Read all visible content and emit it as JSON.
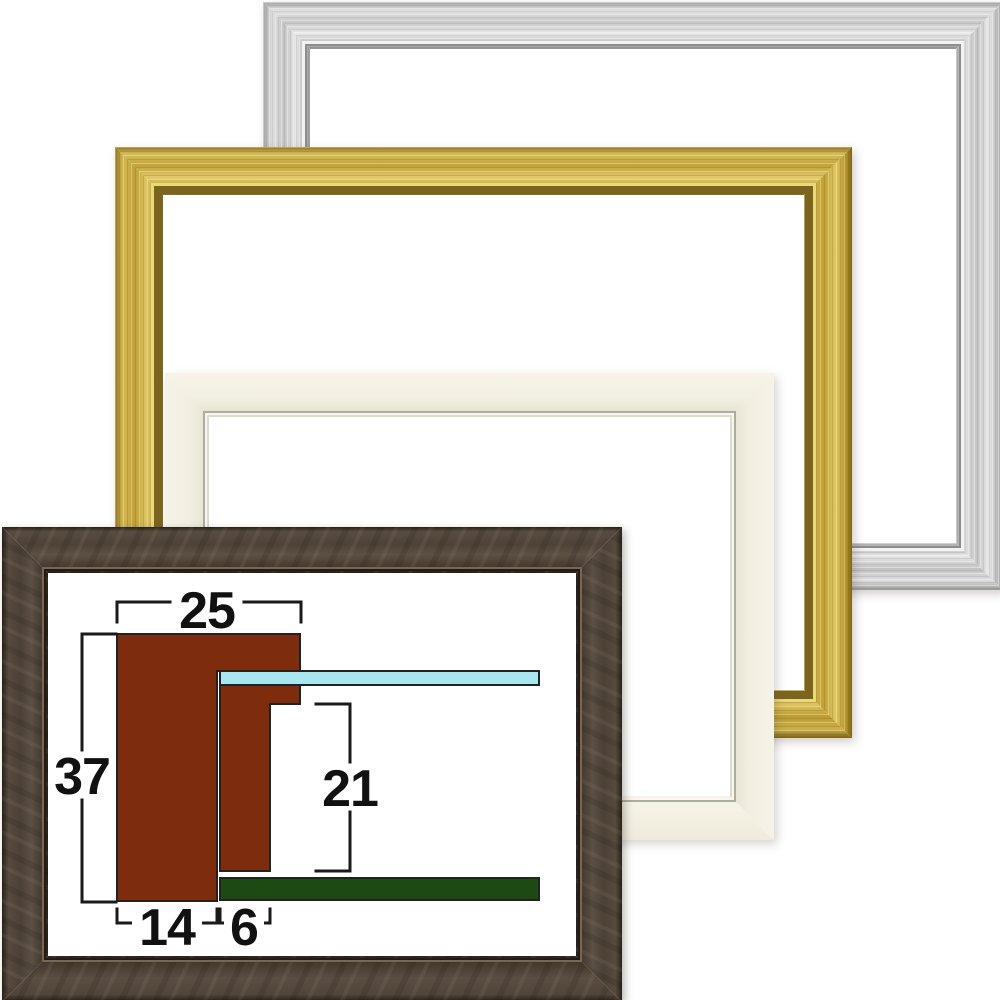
{
  "diagram": {
    "labels": {
      "face_width": "25",
      "total_height": "37",
      "rabbet_depth": "21",
      "base_width": "14",
      "lip_width": "6"
    },
    "colors": {
      "profile": "#7d2c0e",
      "glass": "#a9e7f0",
      "backing_board": "#1d4a12"
    }
  },
  "frames": {
    "silver": {
      "base_color": "#cfcfcf"
    },
    "gold": {
      "base_color": "#c9a93f"
    },
    "cream": {
      "base_color": "#f2efe2"
    },
    "brown": {
      "base_color": "#4e4338"
    }
  }
}
